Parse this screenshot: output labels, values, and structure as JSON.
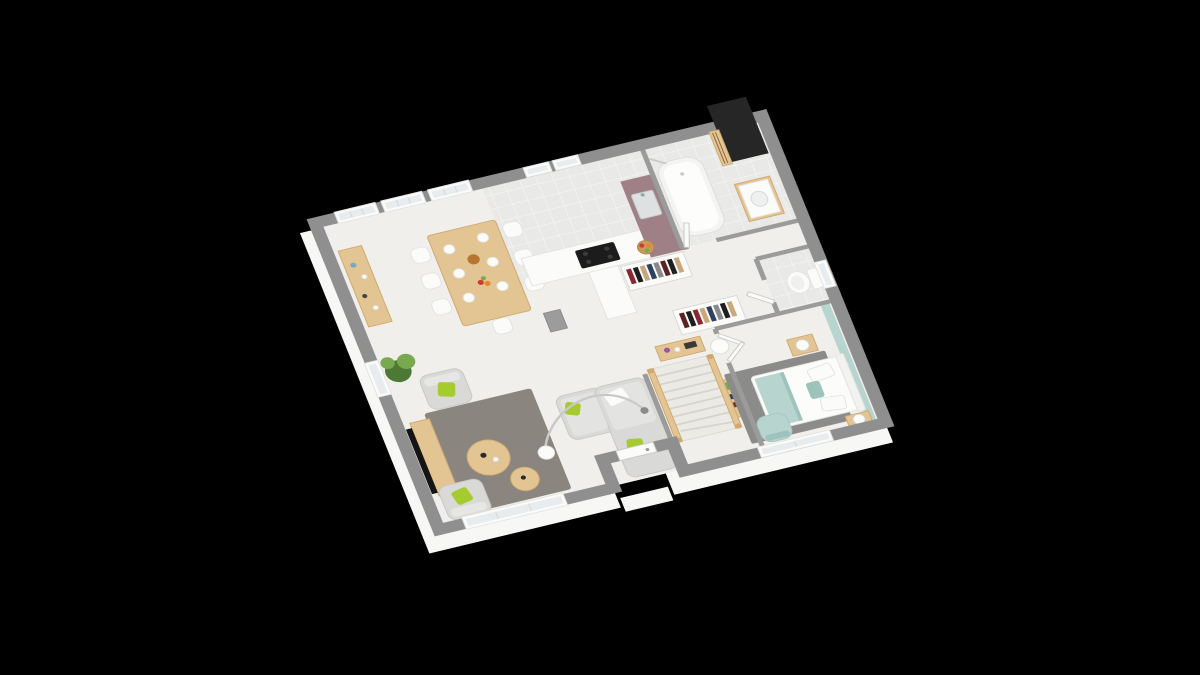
{
  "scene": {
    "description": "3D isometric render of a single-storey house floor plan on a black background",
    "floor_label": "ground-floor",
    "background": "#000000"
  },
  "palette": {
    "background": "#000000",
    "wall": "#8f8f8f",
    "wallInner": "#9b9b9b",
    "foundation": "#f7f7f6",
    "floor": "#f0efec",
    "tile": "#e9e9e7",
    "tileLine": "#f7f7f5",
    "wood": "#e3c493",
    "woodDark": "#cfa96f",
    "white": "#fbfbfa",
    "softGray": "#d9d9d7",
    "rug": "#8a857e",
    "rugBedroom": "#8b8b89",
    "accentGreen": "#a5cb2e",
    "seafoam": "#b7d4ce",
    "seafoamDeep": "#9cc3bc",
    "mauve": "#9f8087",
    "chimney": "#262626",
    "tvBlack": "#141414",
    "cooktop": "#1c1c1c",
    "metal": "#c9c9c9",
    "glass": "#e7edef",
    "plantDark": "#4c7a36",
    "plantLight": "#79a94f",
    "bread": "#b5772f",
    "fruitRed": "#cc3b2f",
    "fruitOrange": "#e08a28",
    "basket": "#c89a5f",
    "flower": "#9a55a8",
    "clothes1": "#8c2731",
    "clothes2": "#1f1f1f",
    "clothes3": "#c9a87c",
    "clothes4": "#30405f",
    "clothes5": "#8a8a8a",
    "clothes6": "#5a2323"
  },
  "rooms": [
    {
      "name": "living-room"
    },
    {
      "name": "dining-area"
    },
    {
      "name": "kitchen"
    },
    {
      "name": "bathroom"
    },
    {
      "name": "wc"
    },
    {
      "name": "hallway-stairs"
    },
    {
      "name": "bedroom"
    },
    {
      "name": "entrance-porch"
    }
  ],
  "furniture": {
    "living-room": [
      "rug",
      "corner-sofa",
      "armchair",
      "armchair",
      "round-coffee-table",
      "round-coffee-table",
      "arc-floor-lamp",
      "tv",
      "tv-stand",
      "plant"
    ],
    "dining-area": [
      "dining-table",
      "chairs",
      "plates",
      "bread",
      "fruit-platter",
      "sideboard"
    ],
    "kitchen": [
      "counter-with-cooktop",
      "sink-unit-mauve",
      "fruit-basket",
      "base-cabinet",
      "wardrobe-with-clothes"
    ],
    "bathroom": [
      "bathtub",
      "shower",
      "vanity-sink"
    ],
    "wc": [
      "toilet"
    ],
    "hallway-stairs": [
      "wooden-staircase",
      "console-table",
      "dressing-closet",
      "paper-floor-lamp",
      "bookshelf"
    ],
    "bedroom": [
      "double-bed",
      "nightstand",
      "nightstand",
      "table-lamp",
      "table-lamp",
      "rug",
      "armchair",
      "accent-wall"
    ],
    "entrance-porch": [
      "front-door",
      "step"
    ]
  }
}
